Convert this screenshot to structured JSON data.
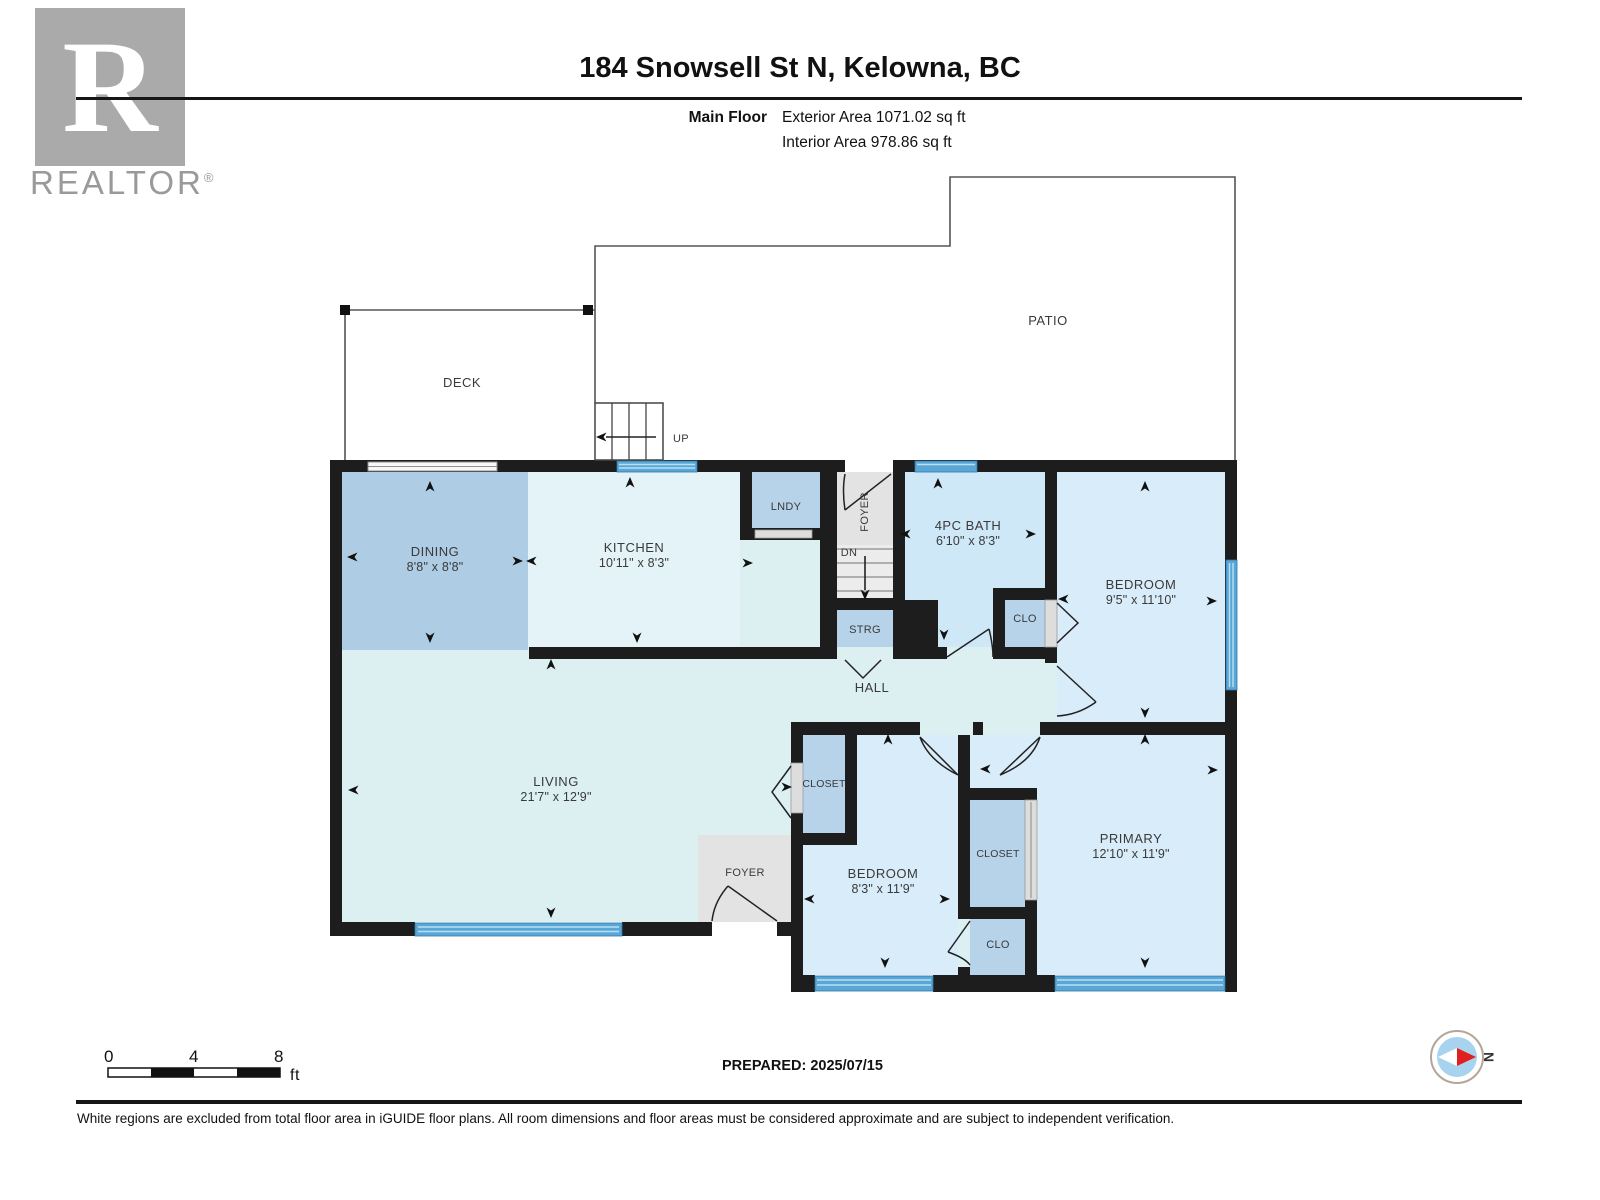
{
  "header": {
    "logo": {
      "letter": "R",
      "brand": "REALTOR",
      "registered": "®"
    },
    "title": "184 Snowsell St N, Kelowna, BC",
    "floor_label": "Main Floor",
    "exterior_area": "Exterior Area 1071.02 sq ft",
    "interior_area": "Interior Area 978.86 sq ft"
  },
  "plan": {
    "outdoor": {
      "deck": "DECK",
      "patio": "PATIO",
      "up": "UP",
      "dn": "DN"
    },
    "rooms": {
      "dining": {
        "name": "DINING",
        "dims": "8'8\" x 8'8\""
      },
      "kitchen": {
        "name": "KITCHEN",
        "dims": "10'11\" x 8'3\""
      },
      "lndy": {
        "name": "LNDY"
      },
      "foyer_top": {
        "name": "FOYER"
      },
      "bath": {
        "name": "4PC BATH",
        "dims": "6'10\" x 8'3\""
      },
      "bedroom_top": {
        "name": "BEDROOM",
        "dims": "9'5\" x 11'10\""
      },
      "strg": {
        "name": "STRG"
      },
      "clo_top": {
        "name": "CLO"
      },
      "hall": {
        "name": "HALL"
      },
      "living": {
        "name": "LIVING",
        "dims": "21'7\" x 12'9\""
      },
      "foyer_bottom": {
        "name": "FOYER"
      },
      "closet_left": {
        "name": "CLOSET"
      },
      "bedroom_bottom": {
        "name": "BEDROOM",
        "dims": "8'3\" x 11'9\""
      },
      "closet_mid": {
        "name": "CLOSET"
      },
      "primary": {
        "name": "PRIMARY",
        "dims": "12'10\" x 11'9\""
      },
      "clo_bottom": {
        "name": "CLO"
      }
    }
  },
  "scale_bar": {
    "tick0": "0",
    "tick1": "4",
    "tick2": "8",
    "unit": "ft"
  },
  "compass": {
    "north": "N"
  },
  "footer": {
    "prepared": "PREPARED: 2025/07/15",
    "disclaimer": "White regions are excluded from total floor area in iGUIDE floor plans. All room dimensions and floor areas must be considered approximate and are subject to independent verification."
  },
  "colors": {
    "wall": "#1d1d1d",
    "window_blue": "#5aa7d7",
    "room_pale_cyan": "#dcf0f2",
    "room_kitchen": "#e4f3f8",
    "room_bath": "#cfe8f8",
    "room_bedroom": "#d9ecfa",
    "room_medium_blue": "#b7d3e9",
    "room_dining": "#aecde4",
    "floor_gray": "#e3e3e4",
    "compass_red": "#e01f1f",
    "compass_blue": "#a8d3ee",
    "logo_gray": "#aaaaaa"
  }
}
